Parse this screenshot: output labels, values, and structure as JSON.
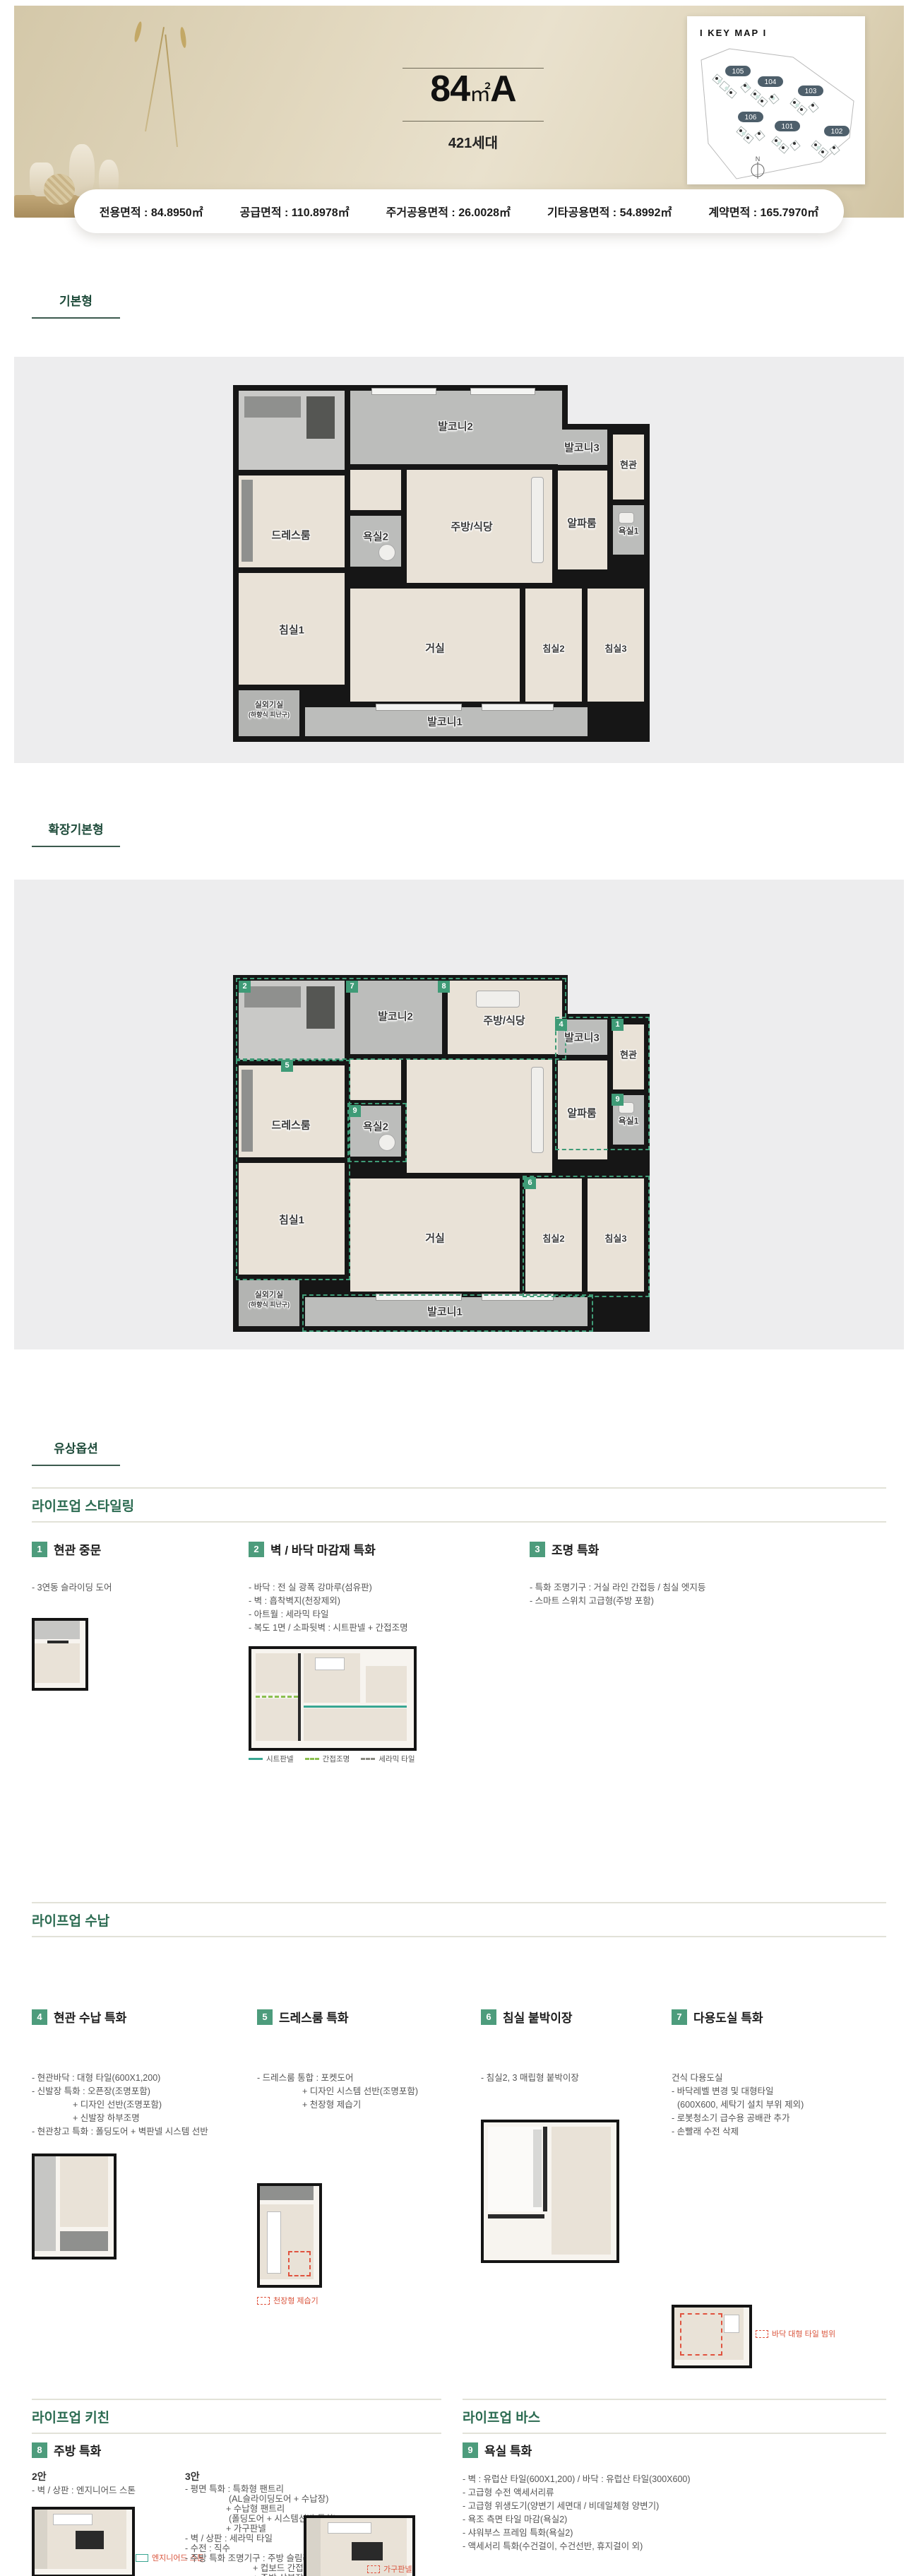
{
  "header": {
    "size": "84",
    "unit": "㎡",
    "type": "A",
    "units": "421세대"
  },
  "keymap": {
    "title": "I KEY MAP I",
    "p101": "101",
    "p102": "102",
    "p103": "103",
    "p104": "104",
    "p105": "105",
    "p106": "106",
    "north": "N"
  },
  "areas": {
    "a1": {
      "label": "전용면적",
      "value": "84.8950㎡"
    },
    "a2": {
      "label": "공급면적",
      "value": "110.8978㎡"
    },
    "a3": {
      "label": "주거공용면적",
      "value": "26.0028㎡"
    },
    "a4": {
      "label": "기타공용면적",
      "value": "54.8992㎡"
    },
    "a5": {
      "label": "계약면적",
      "value": "165.7970㎡"
    }
  },
  "sections": {
    "basic": "기본형",
    "extended": "확장기본형",
    "options": "유상옵션"
  },
  "rooms": {
    "balcony1": "발코니1",
    "balcony2": "발코니2",
    "balcony3": "발코니3",
    "dressroom": "드레스룸",
    "bath2": "욕실2",
    "kitchen": "주방/식당",
    "alpha": "알파룸",
    "entrance": "현관",
    "bath1": "욕실1",
    "bed1": "침실1",
    "living": "거실",
    "bed2": "침실2",
    "bed3": "침실3",
    "ac": "실외기실",
    "ac_sub": "(하향식 피난구)"
  },
  "badges": {
    "n1": "1",
    "n2": "2",
    "n3": "3",
    "n4": "4",
    "n5": "5",
    "n6": "6",
    "n7": "7",
    "n8": "8",
    "n9": "9"
  },
  "styling": {
    "header": "라이프업 스타일링",
    "item1": {
      "num": "1",
      "title": "현관 중문",
      "d1": "- 3연동 슬라이딩 도어"
    },
    "item2": {
      "num": "2",
      "title": "벽 / 바닥 마감재 특화",
      "d1": "- 바닥 : 전 실 광폭 강마루(섬유판)",
      "d2": "- 벽 : 흡착벽지(천장제외)",
      "d3": "- 아트월 : 세라믹 타일",
      "d4": "- 복도 1면 / 소파뒷벽 : 시트판넬 + 간접조명",
      "leg1": "시트판넬",
      "leg2": "간접조명",
      "leg3": "세라믹 타일"
    },
    "item3": {
      "num": "3",
      "title": "조명 특화",
      "d1": "- 특화 조명기구 : 거실 라인 간접등 / 침실 엣지등",
      "d2": "- 스마트 스위치 고급형(주방 포함)"
    }
  },
  "storage": {
    "header": "라이프업 수납",
    "item4": {
      "num": "4",
      "title": "현관 수납 특화",
      "d1": "- 현관바닥 : 대형 타일(600X1,200)",
      "d2": "- 신발장 특화 : 오픈장(조명포함)",
      "d3": "+ 디자인 선반(조명포함)",
      "d4": "+ 신발장 하부조명",
      "d5": "- 현관창고 특화 : 폴딩도어 + 벽판넬 시스템 선반"
    },
    "item5": {
      "num": "5",
      "title": "드레스룸 특화",
      "d1": "- 드레스룸 통합 : 포켓도어",
      "d2": "+ 디자인 시스템 선반(조명포함)",
      "d3": "+ 천장형 제습기",
      "caption": "천장형 제습기"
    },
    "item6": {
      "num": "6",
      "title": "침실 붙박이장",
      "d1": "- 침실2, 3 매립형 붙박이장"
    },
    "item7": {
      "num": "7",
      "title": "다용도실 특화",
      "d1": "건식 다용도실",
      "d2": "- 바닥레벨 변경 및 대형타일",
      "d3": "(600X600, 세탁기 설치 부위 제외)",
      "d4": "- 로봇청소기 급수용 공배관 추가",
      "d5": "- 손빨래 수전 삭제",
      "caption": "바닥 대형 타일 범위"
    }
  },
  "kitchen": {
    "header": "라이프업 키친",
    "num": "8",
    "title": "주방 특화",
    "plan2_label": "2안",
    "p2d1": "- 벽 / 상판 : 엔지니어드 스톤",
    "p2caption": "엔지니어드 스톤",
    "plan3_label": "3안",
    "p3d1": "- 평면 특화 : 특화형 팬트리",
    "p3d2": "(AL슬라이딩도어 + 수납장)",
    "p3d3": "+ 수납형 팬트리",
    "p3d4": "(폴딩도어 + 시스템선반 특화)",
    "p3d5": "+ 가구판넬",
    "p3d6": "- 벽 / 상판 : 세라믹 타일",
    "p3d7": "- 수전 : 직수",
    "p3d8": "- 주방 특화 조명기구 : 주방 슬림라인등 + 식탁 펜던트등",
    "p3d9": "+ 컵보드 간접등",
    "p3d10": "+ 주방 상부장 하부조명",
    "p3d11": "- 액세서리 특화 : 와이드 절수형 싱크볼",
    "p3d12": "+ 미드레일 ACC",
    "p3caption": "가구판넬"
  },
  "bath": {
    "header": "라이프업 바스",
    "num": "9",
    "title": "욕실 특화",
    "d1": "- 벽 : 유럽산 타일(600X1,200) / 바닥 : 유럽산 타일(300X600)",
    "d2": "- 고급형 수전 액세서리류",
    "d3": "- 고급형 위생도기(양변기 세면대 / 비데일체형 양변기)",
    "d4": "- 욕조 측면 타일 마감(욕실2)",
    "d5": "- 샤워부스 프레임 특화(욕실2)",
    "d6": "- 액세서리 특화(수건걸이, 수건선반, 휴지걸이 외)"
  }
}
